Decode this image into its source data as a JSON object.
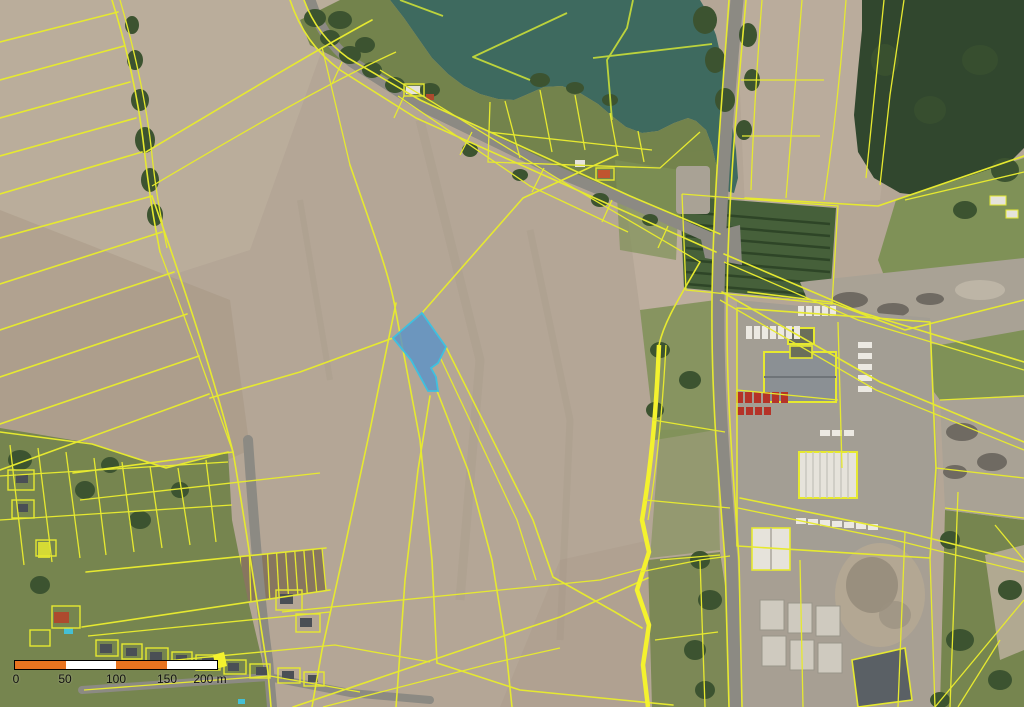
{
  "map": {
    "kind": "cadastral-orthophoto",
    "colors": {
      "field_tan": "#b4a696",
      "field_light": "#c0b2a1",
      "field_dark": "#a08f7c",
      "soil": "#87765f",
      "lake": "#3e6a5f",
      "forest": "#31472e",
      "tree": "#3c5330",
      "shore_green": "#708148",
      "garden": "#76854f",
      "meadow": "#7f9157",
      "orchard": "#46603a",
      "road": "#8c8a83",
      "yard": "#a39e94",
      "gravel": "#a9a295",
      "gravel_dark": "#6f6a62",
      "line_yellow": "#e6e930",
      "line_lime": "#bcd33c",
      "line_bright": "#f4f22e",
      "truck_white": "#ece9e2",
      "truck_red": "#b53328",
      "house_roof": "#4a4f55",
      "red_roof": "#ad4a2e",
      "pool": "#45bfd4",
      "bldg_gray": "#8b9094",
      "bldg_white": "#e6e3db",
      "dark_bldg": "#5a6065"
    },
    "highlight_parcel": {
      "fill": "#5b92c7",
      "stroke": "#3fc0df",
      "fill_opacity": 0.82
    }
  },
  "scale_bar": {
    "labels": [
      "0",
      "50",
      "100",
      "150",
      "200 m"
    ],
    "segment_colors": [
      "#e87420",
      "#ffffff",
      "#e87420",
      "#ffffff"
    ],
    "outline_color": "#000000"
  }
}
